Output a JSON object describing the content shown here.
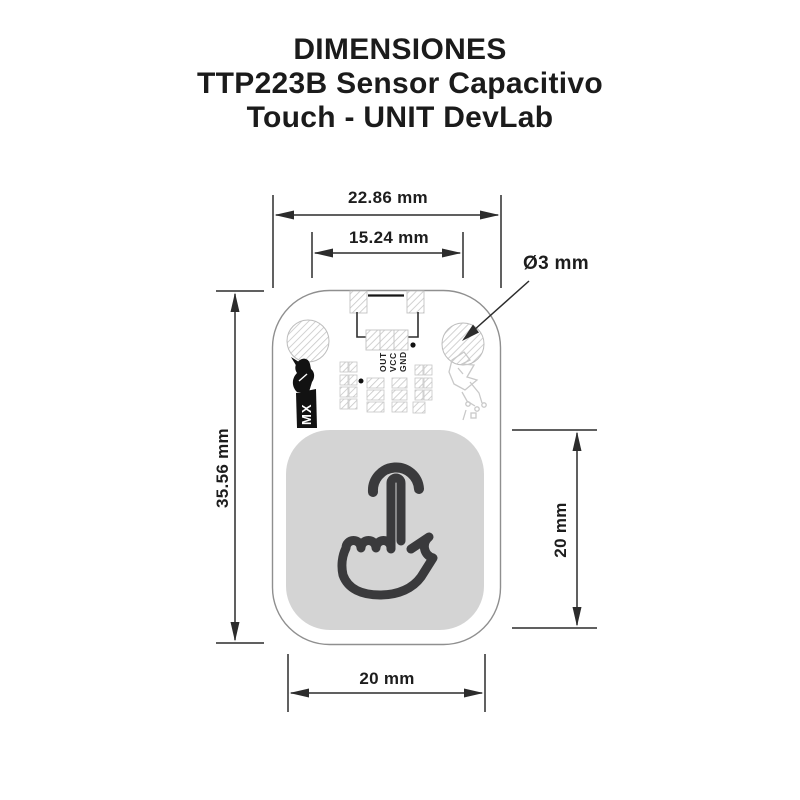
{
  "title": {
    "line1": "DIMENSIONES",
    "line2": "TTP223B Sensor Capacitivo",
    "line3": "Touch - UNIT DevLab"
  },
  "diagram": {
    "type": "mechanical-dimension-drawing",
    "units": "mm",
    "dimensions": {
      "board_width": "22.86 mm",
      "hole_spacing": "15.24 mm",
      "hole_diameter": "Ø3 mm",
      "board_height": "35.56 mm",
      "touch_area_height": "20 mm",
      "touch_area_width": "20 mm"
    },
    "board": {
      "pin_labels": [
        "OUT",
        "VCC",
        "GND"
      ],
      "logo_text": "MX"
    },
    "colors": {
      "background": "#ffffff",
      "title_text": "#1b1b1b",
      "dimension_lines": "#2c2c2c",
      "board_outline": "#8f8f8f",
      "hatch_lines": "#c7c7c7",
      "touch_pad_fill": "#d4d4d4",
      "touch_icon": "#3a3a3c",
      "logo_fill": "#121212"
    }
  }
}
